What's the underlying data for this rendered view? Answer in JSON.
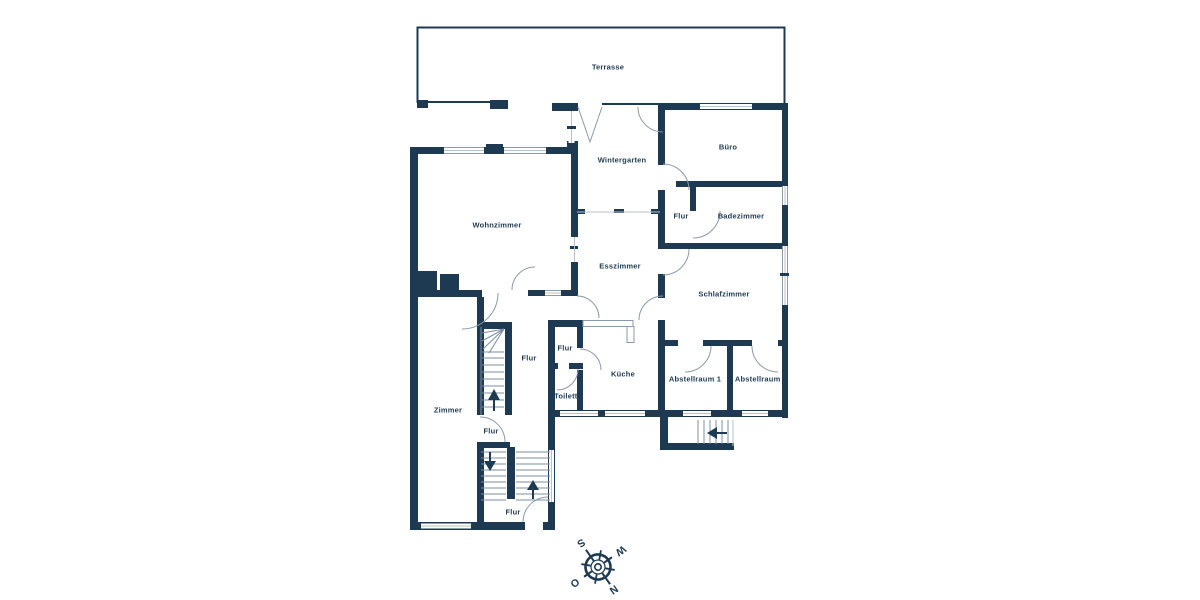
{
  "palette": {
    "background": "#ffffff",
    "wall": "#1e3a52",
    "stair_line": "#7d8da0",
    "glass": "#b7c1cb"
  },
  "rooms": [
    {
      "label": "Terrasse"
    },
    {
      "label": "Wintergarten"
    },
    {
      "label": "Büro"
    },
    {
      "label": "Wohnzimmer"
    },
    {
      "label": "Flur"
    },
    {
      "label": "Badezimmer"
    },
    {
      "label": "Esszimmer"
    },
    {
      "label": "Schlafzimmer"
    },
    {
      "label": "Flur"
    },
    {
      "label": "Flur"
    },
    {
      "label": "Küche"
    },
    {
      "label": "Toilette"
    },
    {
      "label": "Zimmer"
    },
    {
      "label": "Abstellraum 1"
    },
    {
      "label": "Abstellraum 2"
    },
    {
      "label": "Flur"
    },
    {
      "label": "Flur"
    }
  ],
  "compass": {
    "north": "N",
    "east": "O",
    "south": "S",
    "west": "W"
  }
}
